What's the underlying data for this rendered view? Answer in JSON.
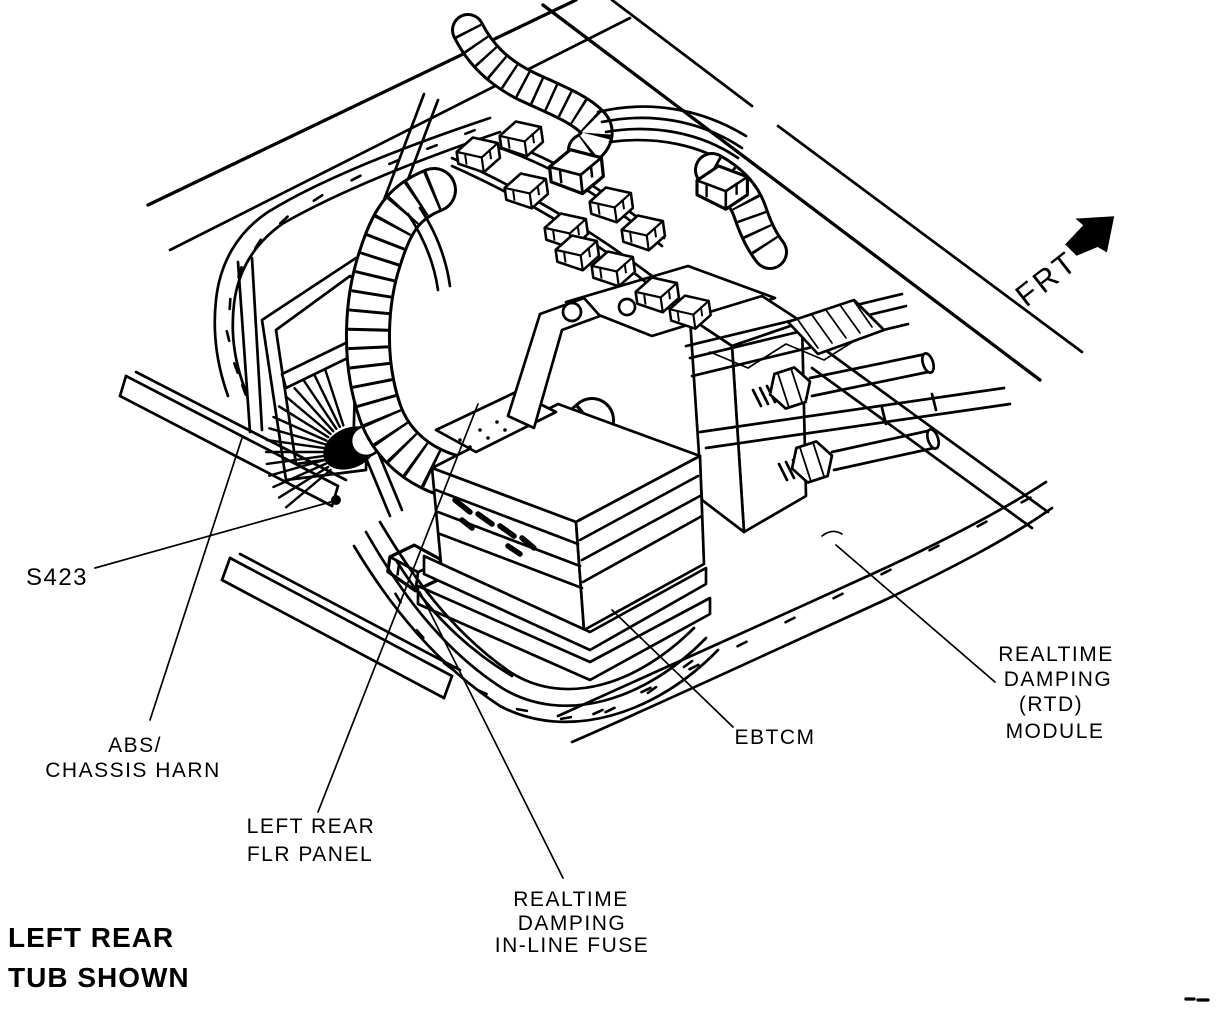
{
  "figure": {
    "type": "technical-illustration",
    "colors": {
      "ink": "#000000",
      "paper": "#ffffff"
    },
    "orientation": {
      "label": "FRT"
    },
    "caption": {
      "line1": "LEFT REAR",
      "line2": "TUB SHOWN"
    },
    "callouts": {
      "splice": {
        "text": "S423"
      },
      "abs_harness": {
        "line1": "ABS/",
        "line2": "CHASSIS HARN"
      },
      "floor_panel": {
        "line1": "LEFT REAR",
        "line2": "FLR PANEL"
      },
      "inline_fuse": {
        "line1": "REALTIME",
        "line2": "DAMPING",
        "line3": "IN-LINE FUSE"
      },
      "ebtcm": {
        "text": "EBTCM"
      },
      "rtd_module": {
        "line1": "REALTIME",
        "line2": "DAMPING",
        "line3": "(RTD)",
        "line4": "MODULE"
      }
    }
  }
}
